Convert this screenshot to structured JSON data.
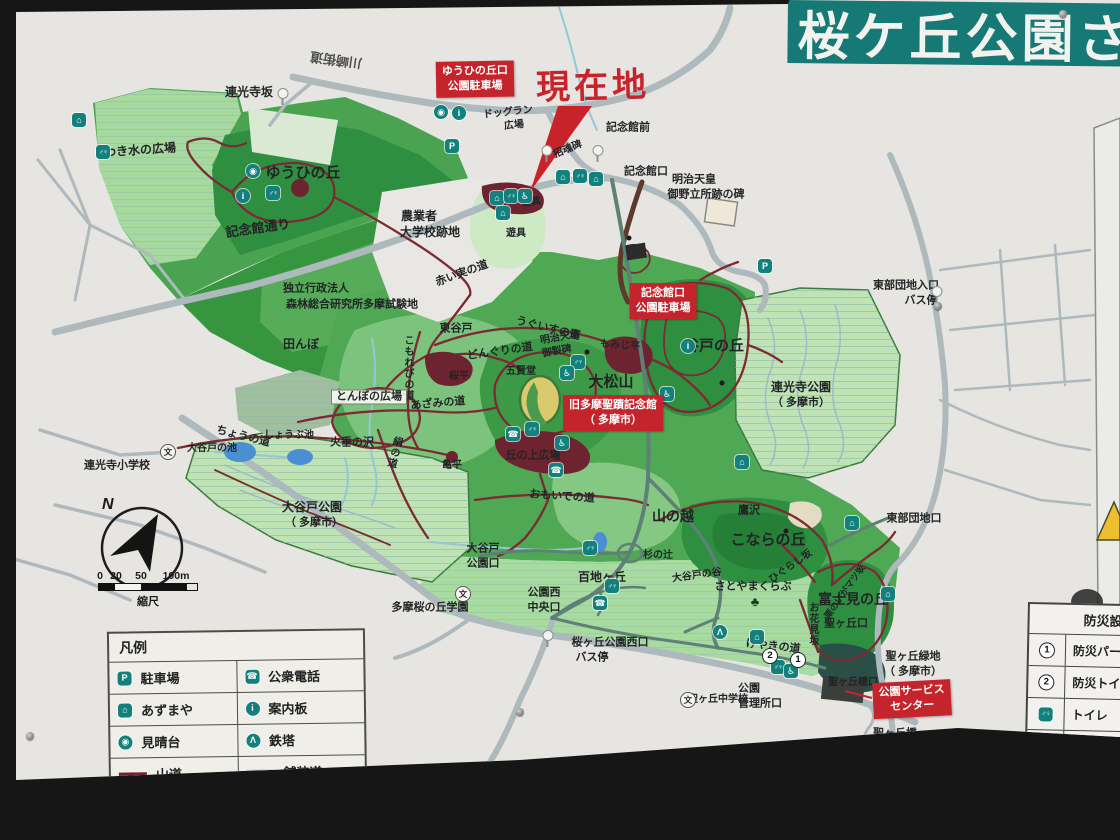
{
  "banner": {
    "title": "桜ケ丘公園",
    "partial": "さ",
    "bg": "#177976"
  },
  "current_location": {
    "label": "現在地"
  },
  "red_signs": [
    {
      "id": "yuhi-parking",
      "lines": [
        "ゆうひの丘口",
        "公園駐車場"
      ],
      "x": 475,
      "y": 79,
      "r": -1
    },
    {
      "id": "kinenkan-parking",
      "lines": [
        "記念館口",
        "公園駐車場"
      ],
      "x": 663,
      "y": 301,
      "r": 0
    },
    {
      "id": "kyu-tama-seiseki-kinenkan",
      "lines": [
        "旧多摩聖蹟記念館",
        "（ 多摩市）"
      ],
      "x": 613,
      "y": 413,
      "r": 0
    },
    {
      "id": "park-service-center",
      "lines": [
        "公園サービス",
        "センター"
      ],
      "x": 912,
      "y": 699,
      "r": -3
    }
  ],
  "labels": [
    {
      "t": "川崎街道",
      "x": 336,
      "y": 60,
      "s": 13,
      "r": 188,
      "c": "#4d4d4d"
    },
    {
      "t": "連光寺坂",
      "x": 249,
      "y": 92,
      "s": 12
    },
    {
      "t": "わき水の広場",
      "x": 140,
      "y": 150,
      "s": 12,
      "r": -4
    },
    {
      "t": "ゆうひの丘",
      "x": 303,
      "y": 173,
      "s": 15
    },
    {
      "t": "記念館通り",
      "x": 258,
      "y": 228,
      "s": 13,
      "r": -8
    },
    {
      "t": "独立行政法人",
      "x": 316,
      "y": 289,
      "s": 11
    },
    {
      "t": "森林総合研究所多摩試験地",
      "x": 352,
      "y": 305,
      "s": 11
    },
    {
      "t": "田んぼ",
      "x": 301,
      "y": 344,
      "s": 12
    },
    {
      "t": "ドッグラン",
      "x": 508,
      "y": 113,
      "s": 10,
      "r": -6
    },
    {
      "t": "広場",
      "x": 514,
      "y": 126,
      "s": 10,
      "r": -6
    },
    {
      "t": "招魂碑",
      "x": 568,
      "y": 150,
      "s": 10,
      "r": -22
    },
    {
      "t": "記念館前",
      "x": 628,
      "y": 128,
      "s": 11
    },
    {
      "t": "記念館口",
      "x": 646,
      "y": 172,
      "s": 11
    },
    {
      "t": "明治天皇",
      "x": 694,
      "y": 180,
      "s": 11
    },
    {
      "t": "御野立所跡の碑",
      "x": 706,
      "y": 195,
      "s": 11
    },
    {
      "t": "農業者",
      "x": 419,
      "y": 216,
      "s": 12
    },
    {
      "t": "大学校跡地",
      "x": 430,
      "y": 232,
      "s": 12
    },
    {
      "t": "遊具",
      "x": 531,
      "y": 203,
      "s": 10,
      "r": -6
    },
    {
      "t": "遊具",
      "x": 516,
      "y": 234,
      "s": 10
    },
    {
      "t": "赤い実の道",
      "x": 462,
      "y": 274,
      "s": 11,
      "r": -20
    },
    {
      "t": "明治天皇",
      "x": 560,
      "y": 338,
      "s": 10,
      "r": -10
    },
    {
      "t": "御製碑",
      "x": 557,
      "y": 352,
      "s": 10,
      "r": -10
    },
    {
      "t": "東谷戸",
      "x": 456,
      "y": 329,
      "s": 11
    },
    {
      "t": "うぐいすの道",
      "x": 548,
      "y": 329,
      "s": 11,
      "r": 14
    },
    {
      "t": "どんぐりの道",
      "x": 500,
      "y": 352,
      "s": 11,
      "r": -8
    },
    {
      "t": "桜平",
      "x": 459,
      "y": 377,
      "s": 10
    },
    {
      "t": "五賢堂",
      "x": 521,
      "y": 372,
      "s": 10
    },
    {
      "t": "大松山",
      "x": 611,
      "y": 382,
      "s": 15
    },
    {
      "t": "もみじ平",
      "x": 620,
      "y": 346,
      "s": 10,
      "r": 4
    },
    {
      "t": "谷戸の丘",
      "x": 714,
      "y": 346,
      "s": 15
    },
    {
      "t": "連光寺公園",
      "x": 801,
      "y": 387,
      "s": 12
    },
    {
      "t": "（ 多摩市）",
      "x": 801,
      "y": 403,
      "s": 11
    },
    {
      "t": "東部団地入口",
      "x": 906,
      "y": 286,
      "s": 11
    },
    {
      "t": "バス停",
      "x": 921,
      "y": 301,
      "s": 11
    },
    {
      "t": "こもれびの道",
      "x": 407,
      "y": 368,
      "s": 10,
      "v": 1
    },
    {
      "t": "あざみの道",
      "x": 438,
      "y": 404,
      "s": 11,
      "r": -5
    },
    {
      "t": "とんぼの広場",
      "x": 369,
      "y": 397,
      "s": 11,
      "bg": 1
    },
    {
      "t": "大谷戸の池",
      "x": 212,
      "y": 449,
      "s": 10
    },
    {
      "t": "しょうぶ池",
      "x": 289,
      "y": 436,
      "s": 10
    },
    {
      "t": "火垂の沢",
      "x": 352,
      "y": 443,
      "s": 11
    },
    {
      "t": "絹の道",
      "x": 393,
      "y": 452,
      "s": 10,
      "v": 1,
      "r": 14
    },
    {
      "t": "ちょうの道",
      "x": 243,
      "y": 437,
      "s": 11,
      "r": 14
    },
    {
      "t": "亀平",
      "x": 452,
      "y": 466,
      "s": 10
    },
    {
      "t": "丘の上広場",
      "x": 533,
      "y": 456,
      "s": 11
    },
    {
      "t": "連光寺小学校",
      "x": 117,
      "y": 466,
      "s": 11
    },
    {
      "t": "大谷戸公園",
      "x": 312,
      "y": 507,
      "s": 12
    },
    {
      "t": "（ 多摩市）",
      "x": 314,
      "y": 523,
      "s": 11
    },
    {
      "t": "おもいでの道",
      "x": 562,
      "y": 497,
      "s": 11,
      "r": 4
    },
    {
      "t": "山の越",
      "x": 673,
      "y": 516,
      "s": 14
    },
    {
      "t": "鷹沢",
      "x": 749,
      "y": 511,
      "s": 11
    },
    {
      "t": "こならの丘",
      "x": 768,
      "y": 540,
      "s": 15
    },
    {
      "t": "東部団地口",
      "x": 914,
      "y": 519,
      "s": 11
    },
    {
      "t": "大谷戸",
      "x": 483,
      "y": 549,
      "s": 11
    },
    {
      "t": "公園口",
      "x": 483,
      "y": 564,
      "s": 11
    },
    {
      "t": "杉の辻",
      "x": 658,
      "y": 556,
      "s": 10
    },
    {
      "t": "大谷戸の谷",
      "x": 697,
      "y": 576,
      "s": 10,
      "r": -8
    },
    {
      "t": "さとやまくらぶ",
      "x": 753,
      "y": 587,
      "s": 11
    },
    {
      "t": "百地ヶ丘",
      "x": 602,
      "y": 577,
      "s": 12
    },
    {
      "t": "多摩桜の丘学園",
      "x": 430,
      "y": 608,
      "s": 11
    },
    {
      "t": "公園西",
      "x": 544,
      "y": 593,
      "s": 11
    },
    {
      "t": "中央口",
      "x": 544,
      "y": 608,
      "s": 11
    },
    {
      "t": "桜ヶ丘公園西口",
      "x": 610,
      "y": 643,
      "s": 11
    },
    {
      "t": "バス停",
      "x": 592,
      "y": 658,
      "s": 11
    },
    {
      "t": "聖ヶ丘口",
      "x": 846,
      "y": 624,
      "s": 11
    },
    {
      "t": "富士見の丘",
      "x": 853,
      "y": 599,
      "s": 14
    },
    {
      "t": "ひぐらし坂",
      "x": 791,
      "y": 567,
      "s": 10,
      "r": -35
    },
    {
      "t": "栗のいがマツ坂",
      "x": 845,
      "y": 592,
      "s": 9,
      "r": -55
    },
    {
      "t": "お花見坂",
      "x": 812,
      "y": 624,
      "s": 10,
      "v": 1
    },
    {
      "t": "けやきの道",
      "x": 773,
      "y": 647,
      "s": 11,
      "r": 6
    },
    {
      "t": "聖ヶ丘緑地",
      "x": 913,
      "y": 657,
      "s": 11
    },
    {
      "t": "（ 多摩市）",
      "x": 913,
      "y": 672,
      "s": 11
    },
    {
      "t": "聖ヶ丘橋口",
      "x": 853,
      "y": 683,
      "s": 10
    },
    {
      "t": "聖ヶ丘中学校",
      "x": 718,
      "y": 700,
      "s": 10
    },
    {
      "t": "公園",
      "x": 749,
      "y": 689,
      "s": 11
    },
    {
      "t": "管理所口",
      "x": 760,
      "y": 704,
      "s": 11
    },
    {
      "t": "聖ヶ丘橋",
      "x": 895,
      "y": 734,
      "s": 11
    },
    {
      "t": "バス停",
      "x": 891,
      "y": 749,
      "s": 11
    }
  ],
  "icon_glyphs": {
    "parking": "P",
    "phone": "☎",
    "azumaya": "⌂",
    "info": "i",
    "viewpoint": "◉",
    "tower": "Λ",
    "toilet": "♂♀",
    "wheelchair": "♿",
    "school": "文",
    "tree": "♣"
  },
  "icons": [
    {
      "k": "azumaya",
      "x": 79,
      "y": 120
    },
    {
      "k": "toilet",
      "x": 103,
      "y": 152
    },
    {
      "k": "viewpoint",
      "x": 253,
      "y": 171
    },
    {
      "k": "info",
      "x": 243,
      "y": 196
    },
    {
      "k": "toilet",
      "x": 273,
      "y": 193
    },
    {
      "k": "viewpoint",
      "x": 441,
      "y": 112
    },
    {
      "k": "info",
      "x": 459,
      "y": 113
    },
    {
      "k": "parking",
      "x": 452,
      "y": 146
    },
    {
      "k": "azumaya",
      "x": 497,
      "y": 198
    },
    {
      "k": "toilet",
      "x": 511,
      "y": 196
    },
    {
      "k": "wheelchair",
      "x": 525,
      "y": 196
    },
    {
      "k": "azumaya",
      "x": 503,
      "y": 213
    },
    {
      "k": "azumaya",
      "x": 563,
      "y": 177
    },
    {
      "k": "toilet",
      "x": 580,
      "y": 176
    },
    {
      "k": "azumaya",
      "x": 596,
      "y": 179
    },
    {
      "k": "parking",
      "x": 765,
      "y": 266
    },
    {
      "k": "info",
      "x": 688,
      "y": 346
    },
    {
      "k": "toilet",
      "x": 578,
      "y": 362
    },
    {
      "k": "wheelchair",
      "x": 567,
      "y": 373
    },
    {
      "k": "phone",
      "x": 513,
      "y": 434
    },
    {
      "k": "toilet",
      "x": 532,
      "y": 429
    },
    {
      "k": "wheelchair",
      "x": 562,
      "y": 443
    },
    {
      "k": "phone",
      "x": 556,
      "y": 470
    },
    {
      "k": "wheelchair",
      "x": 667,
      "y": 394
    },
    {
      "k": "azumaya",
      "x": 742,
      "y": 462
    },
    {
      "k": "azumaya",
      "x": 852,
      "y": 523
    },
    {
      "k": "azumaya",
      "x": 888,
      "y": 594
    },
    {
      "k": "tower",
      "x": 720,
      "y": 632
    },
    {
      "k": "azumaya",
      "x": 757,
      "y": 637
    },
    {
      "k": "toilet",
      "x": 612,
      "y": 586
    },
    {
      "k": "phone",
      "x": 600,
      "y": 603
    },
    {
      "k": "toilet",
      "x": 590,
      "y": 548
    },
    {
      "k": "toilet",
      "x": 778,
      "y": 667
    },
    {
      "k": "wheelchair",
      "x": 791,
      "y": 671
    },
    {
      "k": "school",
      "x": 168,
      "y": 452
    },
    {
      "k": "school",
      "x": 463,
      "y": 594
    },
    {
      "k": "school",
      "x": 688,
      "y": 700
    },
    {
      "k": "tree",
      "x": 755,
      "y": 601
    }
  ],
  "bus_stops": [
    {
      "x": 283,
      "y": 99
    },
    {
      "x": 547,
      "y": 156
    },
    {
      "x": 598,
      "y": 156
    },
    {
      "x": 937,
      "y": 297
    },
    {
      "x": 548,
      "y": 641
    },
    {
      "x": 874,
      "y": 757
    }
  ],
  "dots": [
    {
      "x": 629,
      "y": 238
    },
    {
      "x": 587,
      "y": 352
    },
    {
      "x": 722,
      "y": 383
    },
    {
      "x": 786,
      "y": 531
    }
  ],
  "numbers": [
    {
      "n": "2",
      "x": 770,
      "y": 656
    },
    {
      "n": "1",
      "x": 798,
      "y": 660
    }
  ],
  "legend": {
    "title": "凡例",
    "rows": [
      [
        {
          "icon": "parking",
          "label": "駐車場"
        },
        {
          "icon": "phone",
          "label": "公衆電話"
        }
      ],
      [
        {
          "icon": "azumaya",
          "label": "あずまや"
        },
        {
          "icon": "info",
          "label": "案内板"
        }
      ],
      [
        {
          "icon": "viewpoint",
          "label": "見晴台"
        },
        {
          "icon": "tower",
          "label": "鉄塔"
        }
      ],
      [
        {
          "icon": "trail-line",
          "label": "山道"
        },
        {
          "icon": "paved-line",
          "label": "舗装道"
        }
      ]
    ]
  },
  "bousai": {
    "title": "防災設備",
    "rows": [
      {
        "sym": "num1",
        "n": "1",
        "label": "防災パー"
      },
      {
        "sym": "num2",
        "n": "2",
        "label": "防災トイ"
      },
      {
        "sym": "toilet",
        "label": "トイレ"
      },
      {
        "sym": "wheelchair",
        "label": "障害者ト"
      },
      {
        "sym": "swatch",
        "label": "桜ヶ丘公"
      }
    ]
  },
  "compass": {
    "north": "N"
  },
  "scalebar": {
    "ticks": [
      "0",
      "20",
      "50",
      "100m"
    ],
    "label": "縮尺"
  }
}
